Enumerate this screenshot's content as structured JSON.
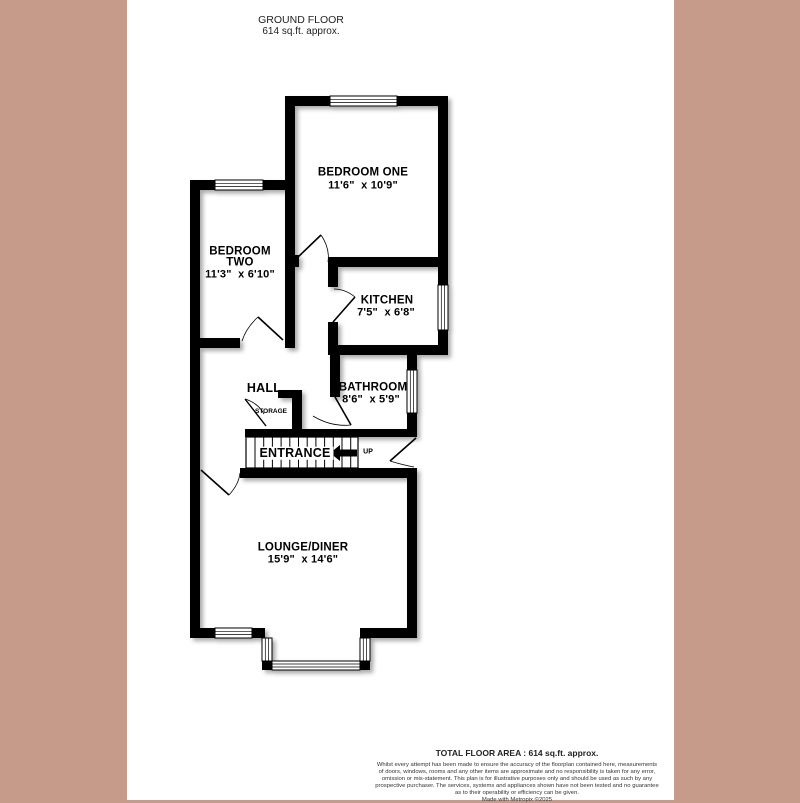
{
  "header": {
    "title": "GROUND FLOOR",
    "subtitle": "614 sq.ft. approx."
  },
  "rooms": {
    "bedroom_one": {
      "name": "BEDROOM ONE",
      "dims": "11'6\"  x 10'9\""
    },
    "bedroom_two": {
      "name_line1": "BEDROOM",
      "name_line2": "TWO",
      "dims": "11'3\"  x 6'10\""
    },
    "kitchen": {
      "name": "KITCHEN",
      "dims": "7'5\"  x 6'8\""
    },
    "bathroom": {
      "name": "BATHROOM",
      "dims": "8'6\"  x 5'9\""
    },
    "hall": {
      "name": "HALL"
    },
    "storage": {
      "name": "STORAGE"
    },
    "entrance": {
      "name": "ENTRANCE",
      "up_label": "UP"
    },
    "lounge": {
      "name": "LOUNGE/DINER",
      "dims": "15'9\"  x 14'6\""
    }
  },
  "footer": {
    "total_area": "TOTAL FLOOR AREA : 614 sq.ft. approx.",
    "disclaimer_lines": [
      "Whilst every attempt has been made to ensure the accuracy of the floorplan contained here, measurements",
      "of doors, windows, rooms and any other items are approximate and no responsibility is taken for any error,",
      "omission or mis-statement. This plan is for illustrative purposes only and should be used as such by any",
      "prospective purchaser. The services, systems and appliances shown have not been tested and no guarantee",
      "as to their operability or efficiency can be given."
    ],
    "credit": "Made with Metropix ©2025"
  },
  "colors": {
    "page_border": "#c79b8a",
    "wall": "#000000",
    "floor": "#ffffff"
  }
}
